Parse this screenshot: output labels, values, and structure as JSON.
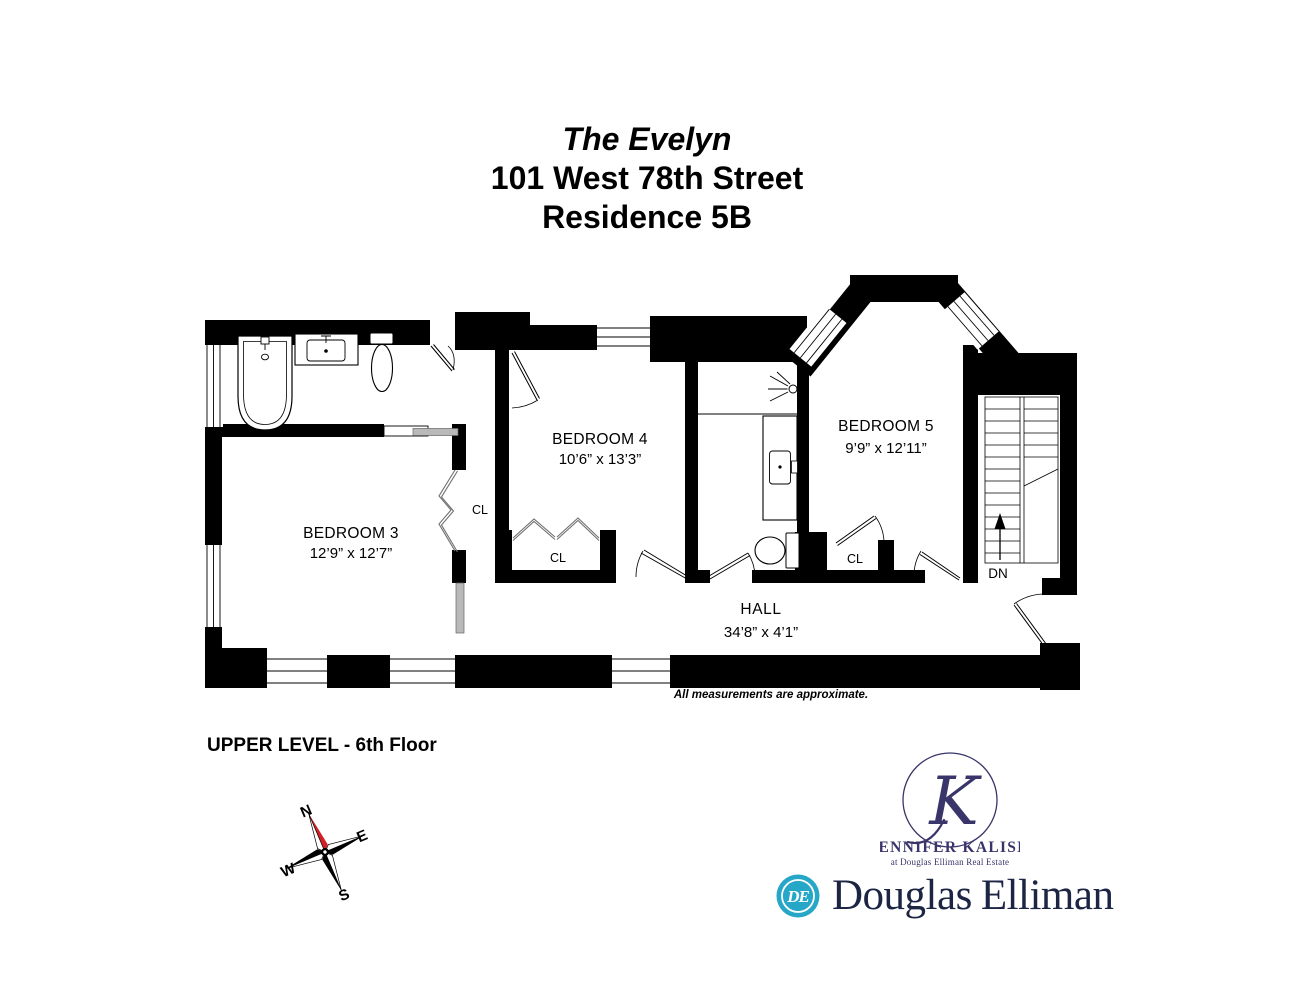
{
  "title": {
    "building": "The Evelyn",
    "address": "101 West 78th Street",
    "residence": "Residence 5B"
  },
  "floorplan": {
    "rooms": [
      {
        "name": "BEDROOM 3",
        "dims": "12’9” x 12’7”"
      },
      {
        "name": "BEDROOM 4",
        "dims": "10’6” x 13’3”"
      },
      {
        "name": "BEDROOM 5",
        "dims": "9’9” x 12’11”"
      },
      {
        "name": "HALL",
        "dims": "34’8” x 4’1”"
      }
    ],
    "closet_label": "CL",
    "stairs_down_label": "DN",
    "note": "All measurements are approximate.",
    "level_label": "UPPER LEVEL - 6th Floor"
  },
  "compass": {
    "north": "N",
    "east": "E",
    "south": "S",
    "west": "W",
    "needle_color": "#d01f26"
  },
  "agent": {
    "monogram": "K",
    "name": "JENNIFER KALISH",
    "tagline": "at Douglas Elliman Real Estate",
    "brand_color": "#39356a"
  },
  "brand": {
    "monogram": "DE",
    "word1": "Douglas",
    "word2": "Elliman",
    "circle_color": "#27a7c8",
    "text_color": "#1d2544"
  }
}
